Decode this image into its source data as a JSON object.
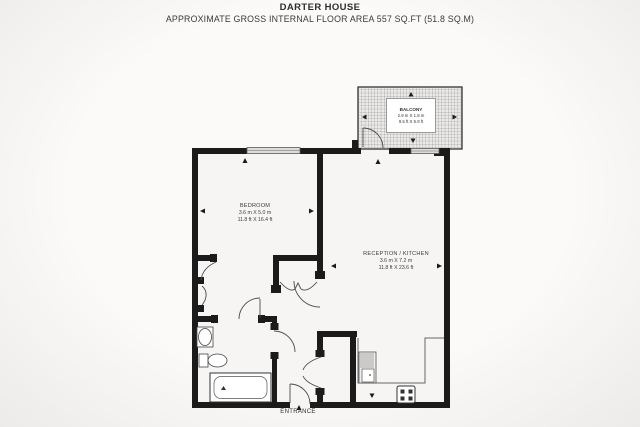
{
  "header": {
    "title": "DARTER HOUSE",
    "subtitle": "APPROXIMATE GROSS INTERNAL FLOOR AREA 557 SQ.FT (51.8 SQ.M)"
  },
  "rooms": {
    "bedroom": {
      "name": "BEDROOM",
      "metric": "3.6 m X 5.0 m",
      "imperial": "11.8 ft X 16.4 ft"
    },
    "reception": {
      "name": "RECEPTION / KITCHEN",
      "metric": "3.6 m X 7.2 m",
      "imperial": "11.8 ft X 23.6 ft"
    },
    "balcony": {
      "name": "BALCONY",
      "metric": "2.9 m X 1.8 m",
      "imperial": "9.5 ft X 5.9 ft"
    }
  },
  "labels": {
    "entrance": "ENTRANCE"
  },
  "colors": {
    "wall": "#1b1b1b",
    "thin_line": "#4a4a4a",
    "paper": "#f6f5f4",
    "hatch": "#7d7d7d"
  }
}
